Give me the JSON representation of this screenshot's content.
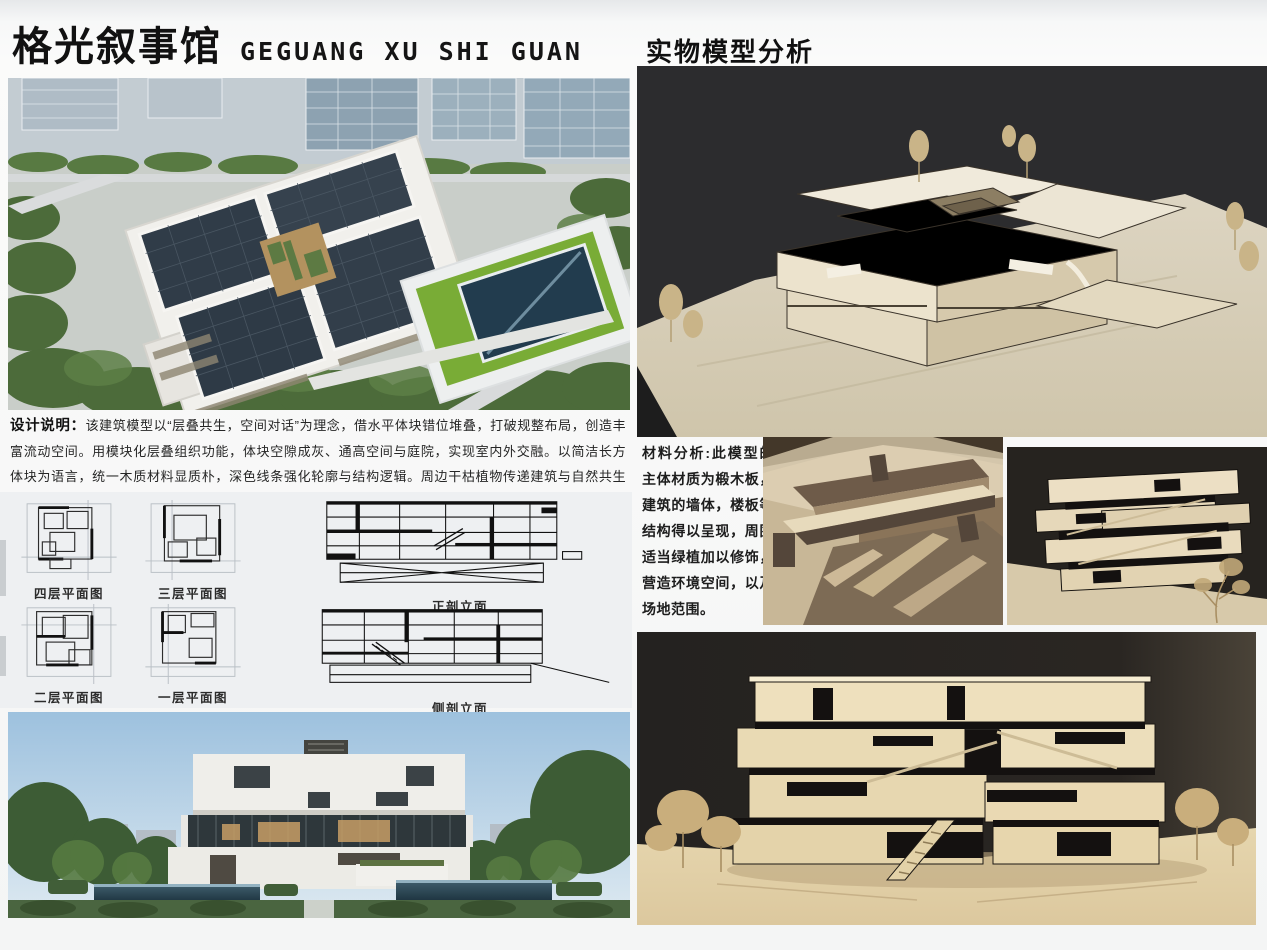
{
  "header": {
    "title_cn": "格光叙事馆",
    "title_en": "GEGUANG XU SHI GUAN"
  },
  "right_header": {
    "title": "实物模型分析"
  },
  "design_note": {
    "label": "设计说明：",
    "text": "该建筑模型以“层叠共生，空间对话”为理念，借水平体块错位堆叠，打破规整布局，创造丰富流动空间。用模块化层叠组织功能，体块空隙成灰、通高空间与庭院，实现室内外交融。以简洁长方体块为语言，统一木质材料显质朴，深色线条强化轮廓与结构逻辑。周边干枯植物传递建筑与自然共生思考，展现建筑空间、形式与场地协同的设计探索 。"
  },
  "drawings": {
    "plans": [
      {
        "label": "四层平面图"
      },
      {
        "label": "三层平面图"
      },
      {
        "label": "二层平面图"
      },
      {
        "label": "一层平面图"
      }
    ],
    "sections": [
      {
        "label": "正剖立面"
      },
      {
        "label": "侧剖立面"
      }
    ]
  },
  "material_note": {
    "label": "材料分析:",
    "text": "此模型的主体材质为椴木板，建筑的墙体，楼板等结构得以呈现，周围适当绿植加以修饰，营造环境空间，以及场地范围。"
  },
  "colors": {
    "title_text": "#111111",
    "board_background": "#f6f7f7",
    "drawing_panel": "#eef0f2",
    "photo_dark_background": "#2b2a28",
    "model_wood_cream": "#e9dfc6",
    "model_wood_brown": "#7d6a54",
    "render_roof_dark": "#323e4a",
    "render_lawn_green": "#79ac36",
    "render_tree_green": "#4c6b3a",
    "render_sky_blue": "#a6c6e0"
  }
}
